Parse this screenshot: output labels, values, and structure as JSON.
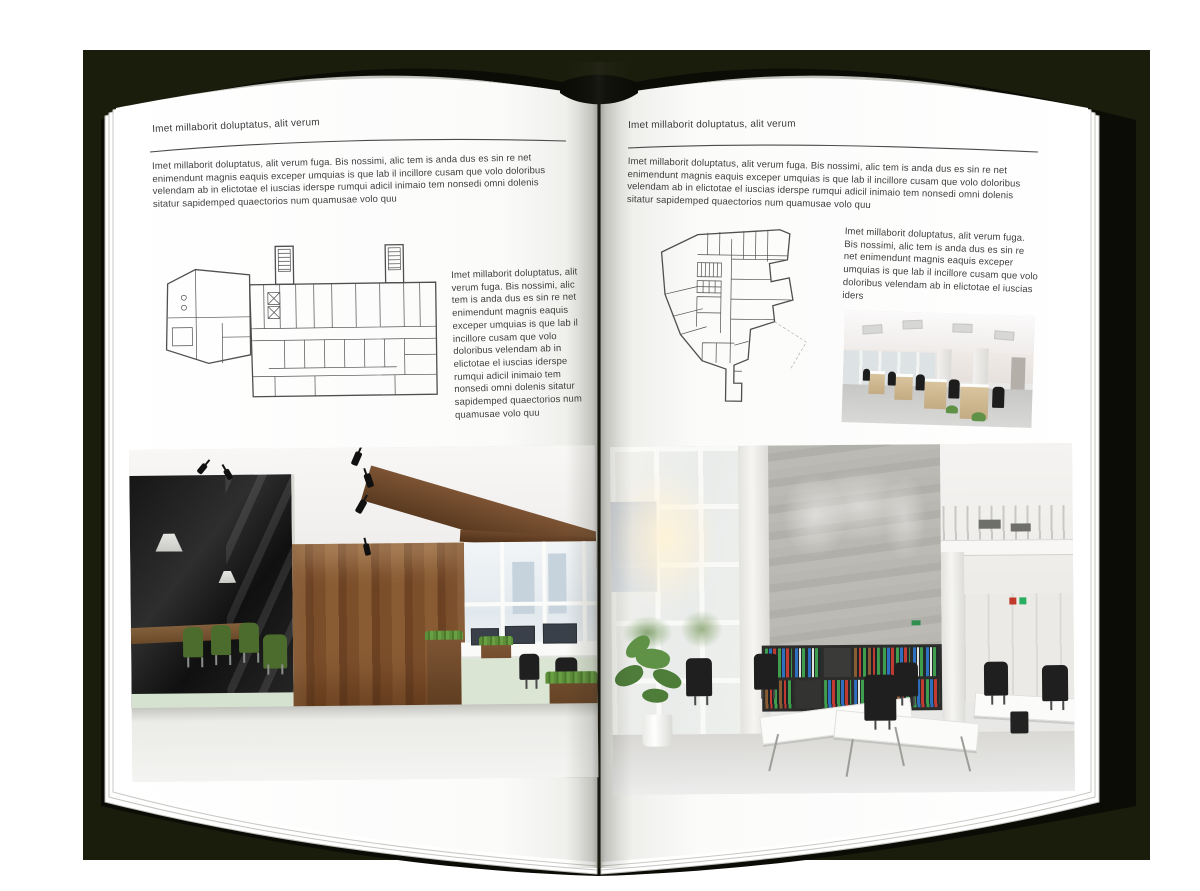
{
  "colors": {
    "backdrop": "#1b1d0c",
    "page": "#ffffff",
    "text": "#3e3e3e",
    "rule": "#4b4b4b",
    "plan_line": "#4f4f4f"
  },
  "left_page": {
    "header": "Imet millaborit doluptatus, alit verum",
    "intro": "Imet millaborit doluptatus, alit verum fuga. Bis nossimi, alic tem is anda dus es sin re net enimendunt magnis eaquis exceper umquias is que lab il incillore cusam que volo doloribus velendam ab in elictotae el iuscias iderspe rumqui adicil inimaio tem nonsedi omni dolenis sitatur sapidemped quaectorios num quamusae volo quu",
    "side_text": "Imet millaborit doluptatus, alit verum fuga. Bis nossimi, alic tem is anda dus es sin re net enimendunt magnis eaquis exceper umquias is que lab il incillore cusam que volo doloribus velendam ab in elictotae el iuscias iderspe rumqui adicil inimaio tem nonsedi omni dolenis sitatur sapidemped quaectorios num quamusae volo quu"
  },
  "right_page": {
    "header": "Imet millaborit doluptatus, alit verum",
    "intro": "Imet millaborit doluptatus, alit verum fuga. Bis nossimi, alic tem is anda dus es sin re net enimendunt magnis eaquis exceper umquias is que lab il incillore cusam que volo doloribus velendam ab in elictotae el iuscias iderspe rumqui adicil inimaio tem nonsedi omni dolenis sitatur sapidemped quaectorios num quamusae volo quu",
    "side_text": "Imet millaborit doluptatus, alit verum fuga. Bis nossimi, alic tem is anda dus es sin re net enimendunt magnis eaquis exceper umquias is que lab il incillore cusam que volo doloribus velendam ab in elictotae el iuscias iders"
  }
}
